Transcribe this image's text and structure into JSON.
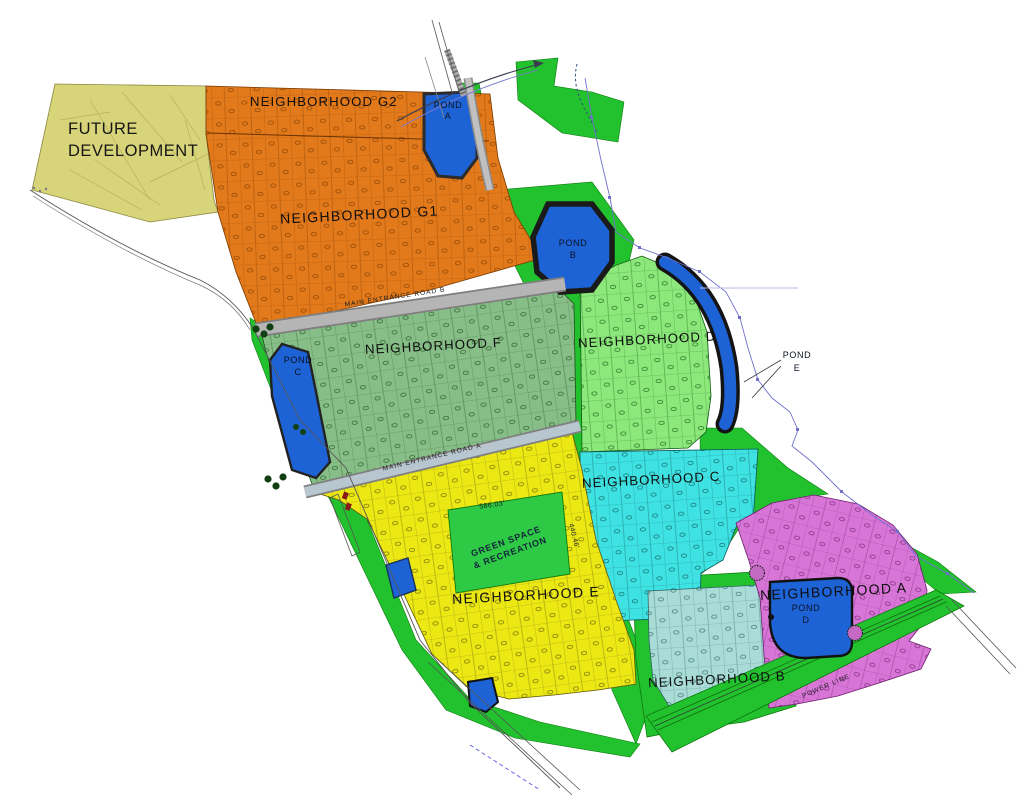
{
  "map_title": "Master planned community site plan",
  "regions": {
    "future_development": {
      "line1": "FUTURE",
      "line2": "DEVELOPMENT",
      "color": "#d8d47a"
    },
    "g2": {
      "name": "NEIGHBORHOOD G2",
      "color": "#e2791b"
    },
    "g1": {
      "name": "NEIGHBORHOOD G1",
      "color": "#e2791b"
    },
    "f": {
      "name": "NEIGHBORHOOD F",
      "color": "#87bd87"
    },
    "d": {
      "name": "NEIGHBORHOOD D",
      "color": "#8ce87b"
    },
    "c": {
      "name": "NEIGHBORHOOD C",
      "color": "#3fe2e2"
    },
    "e": {
      "name": "NEIGHBORHOOD E",
      "color": "#ece814"
    },
    "a": {
      "name": "NEIGHBORHOOD A",
      "color": "#d876d8"
    },
    "b": {
      "name": "NEIGHBORHOOD B",
      "color": "#a9dcd6"
    },
    "green_space": {
      "line1": "GREEN SPACE",
      "line2": "& RECREATION",
      "color": "#2fca45"
    }
  },
  "open_space_color": "#22c12e",
  "ponds": {
    "color": "#1e63d6",
    "a": {
      "line1": "POND",
      "line2": "A"
    },
    "b": {
      "line1": "POND",
      "line2": "B"
    },
    "c": {
      "line1": "POND",
      "line2": "C"
    },
    "d": {
      "line1": "POND",
      "line2": "D"
    },
    "e": {
      "line1": "POND",
      "line2": "E"
    }
  },
  "roads": {
    "main_entrance_b": "MAIN ENTRANCE ROAD B",
    "main_entrance_a": "MAIN ENTRANCE ROAD A",
    "power_line": "POWER LINE"
  },
  "dimensions": {
    "green_space_width": "586.03'",
    "green_space_height": "440.46'"
  }
}
